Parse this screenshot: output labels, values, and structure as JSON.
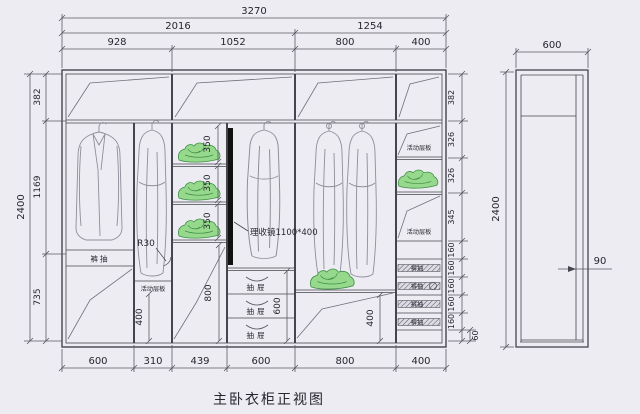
{
  "title": "主卧衣柜正视图",
  "colors": {
    "background": "#edecf3",
    "cabinet_line": "#45454d",
    "dimension_line": "#5a5a63",
    "garment_line": "#8e8e99",
    "green_fill": "#97d98c",
    "green_stroke": "#3f8f46",
    "mirror": "#111111"
  },
  "dims": {
    "top_total": "3270",
    "top_row2": [
      "2016",
      "1254"
    ],
    "top_row3": [
      "928",
      "1052",
      "800",
      "400"
    ],
    "left_height": "2400",
    "left_segments": [
      "382",
      "1169",
      "735"
    ],
    "right_segments": [
      "382",
      "326",
      "326",
      "345",
      "160",
      "160",
      "160",
      "160",
      "160",
      "60"
    ],
    "bottom_widths": [
      "600",
      "310",
      "439",
      "600",
      "800",
      "400"
    ],
    "shelf_gap": "350",
    "col3_lower": "800",
    "col2_lower": "400",
    "drawer_stack": "600",
    "col5_lower": "400",
    "side_width": "600",
    "side_height": "2400",
    "side_inset": "90"
  },
  "labels": {
    "pants_drawer": "裤抽",
    "corner_radius": "R30",
    "movable_shelf": "活动层板",
    "mirror": "理收镜1100*400",
    "drawer": "抽屉",
    "trouser_rack": "裤抽"
  }
}
